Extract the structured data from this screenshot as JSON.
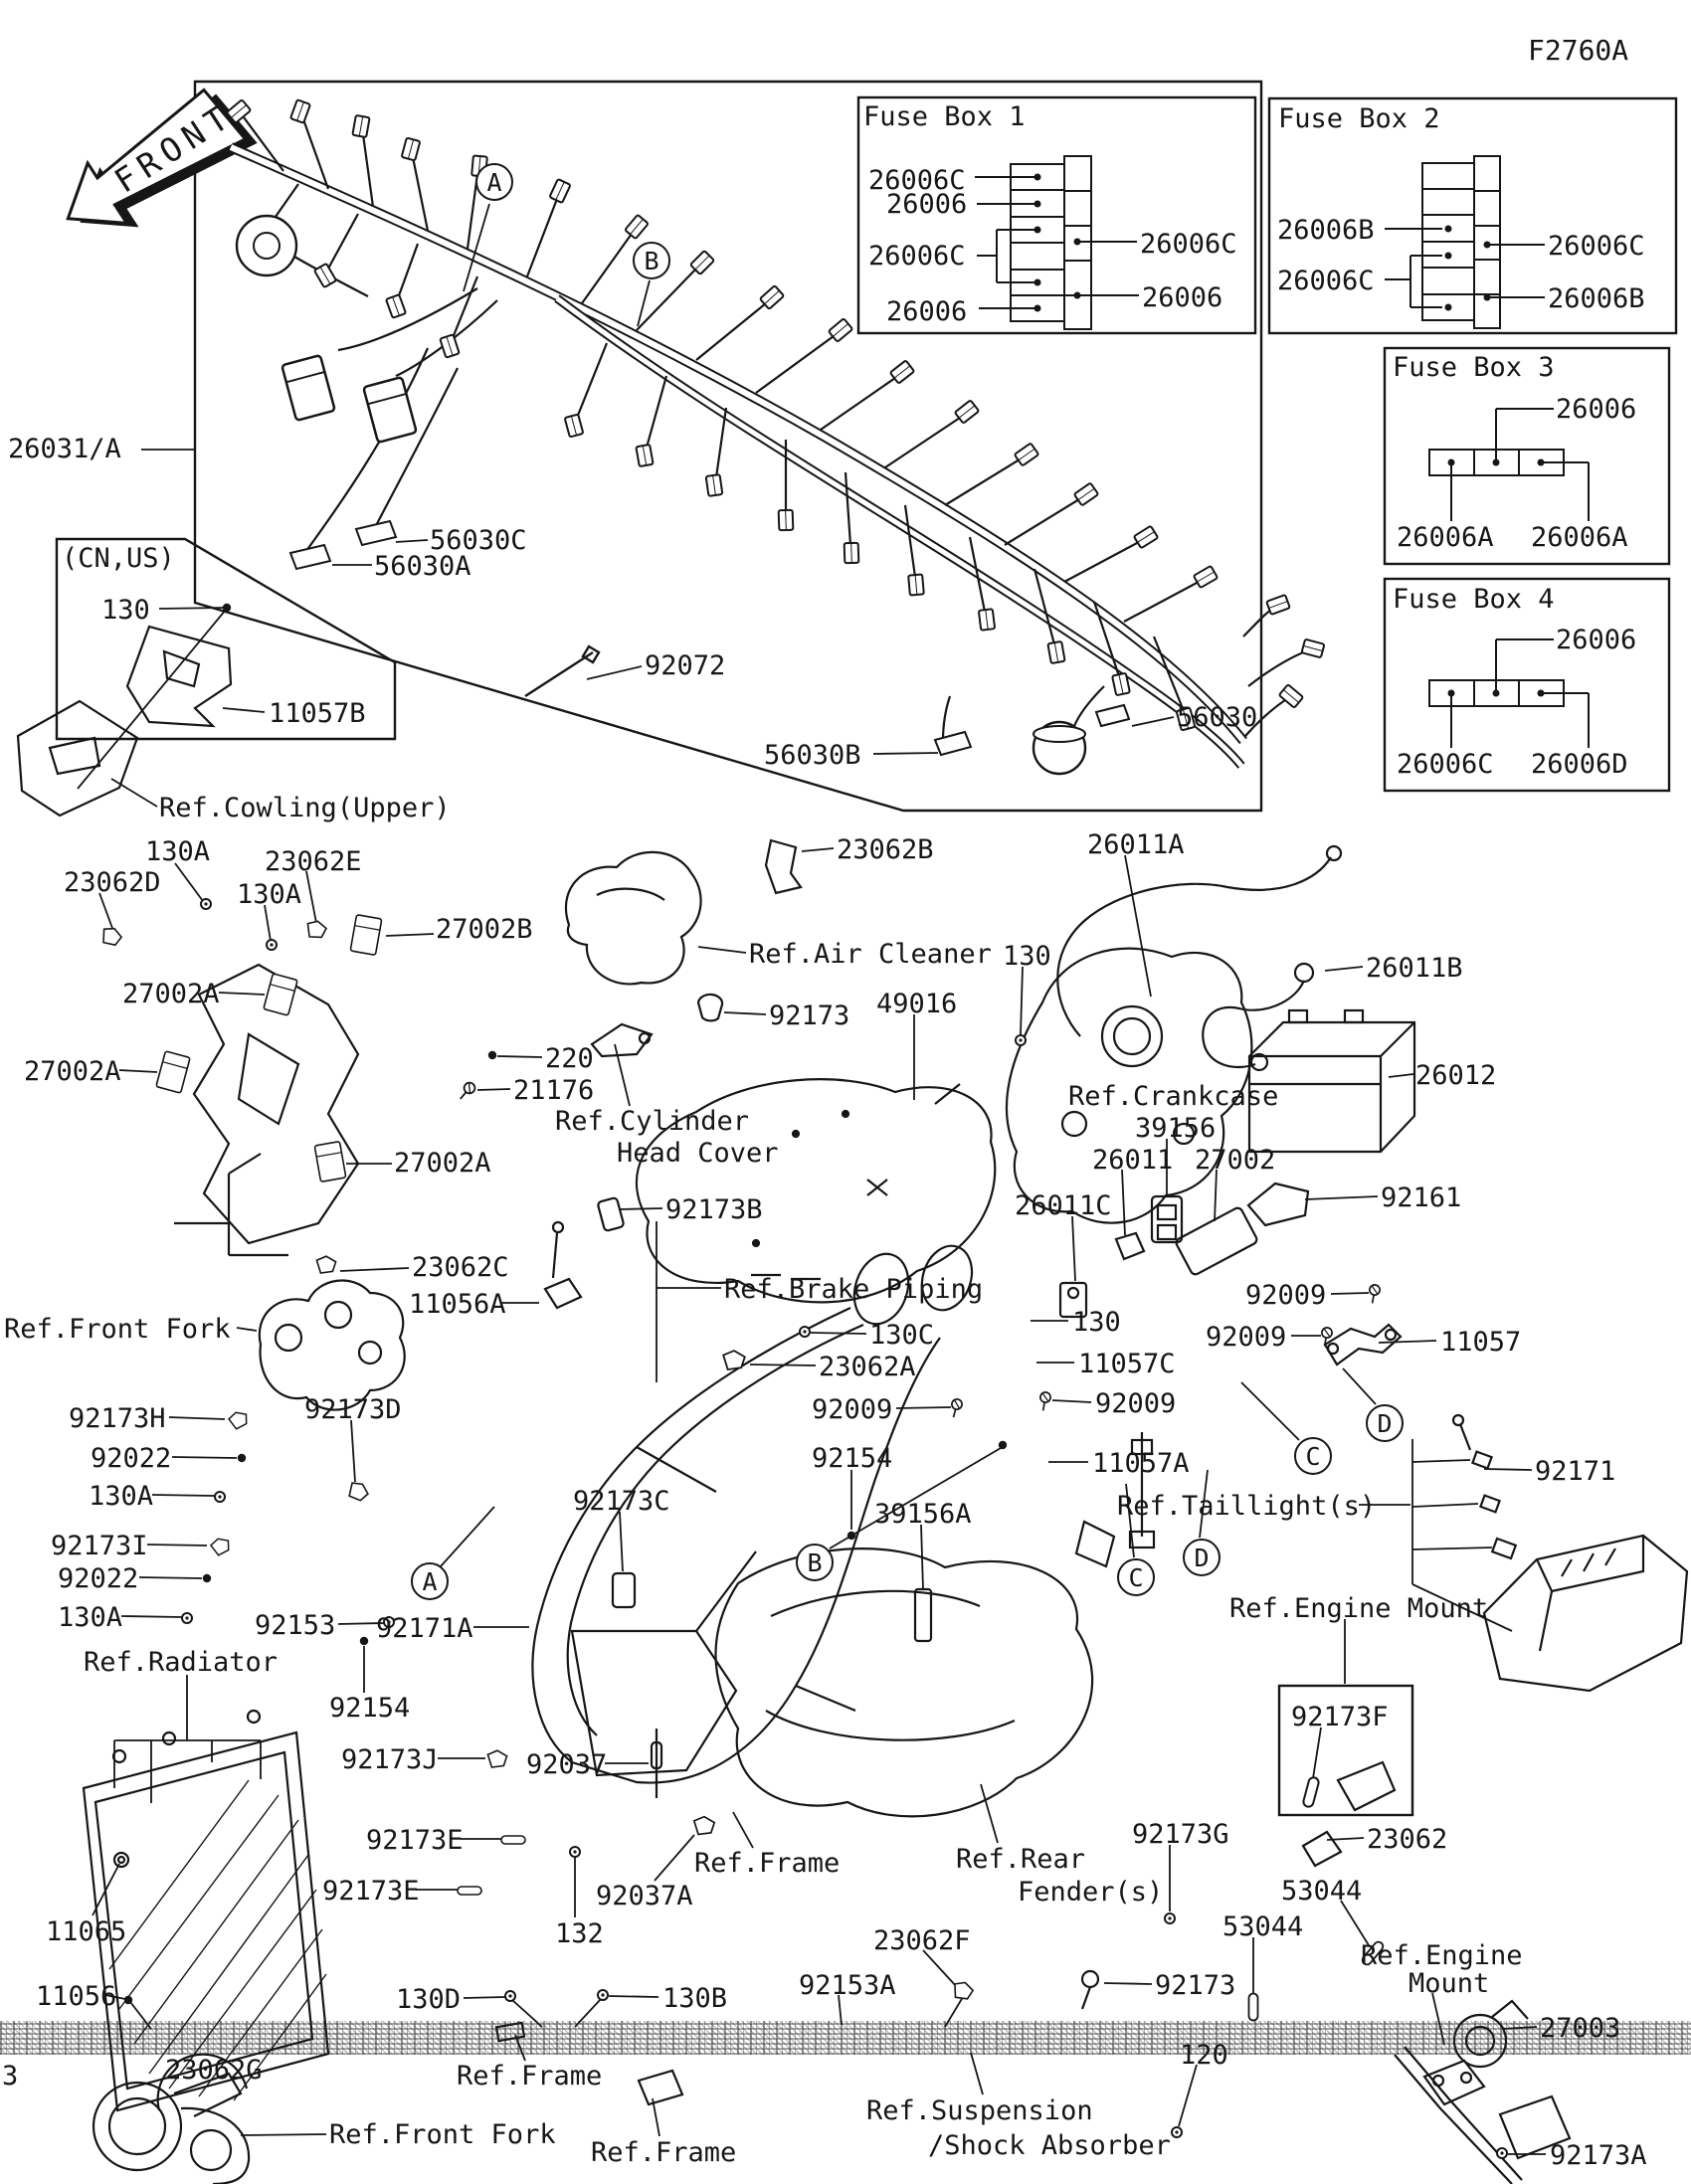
{
  "page": {
    "code": "F2760A",
    "front_arrow": "FRONT"
  },
  "fuse_boxes": [
    {
      "title": "Fuse Box 1",
      "left": [
        "26006C",
        "26006",
        "26006C",
        "26006"
      ],
      "right": [
        "26006C",
        "26006"
      ]
    },
    {
      "title": "Fuse Box 2",
      "left": [
        "26006B",
        "26006C"
      ],
      "right": [
        "26006C",
        "26006B"
      ]
    },
    {
      "title": "Fuse Box 3",
      "top": "26006",
      "bottom": [
        "26006A",
        "26006A"
      ]
    },
    {
      "title": "Fuse Box 4",
      "top": "26006",
      "bottom": [
        "26006C",
        "26006D"
      ]
    }
  ],
  "markers": [
    "A",
    "B",
    "A",
    "B",
    "C",
    "D",
    "C",
    "D"
  ],
  "labels": [
    {
      "text": "26031/A"
    },
    {
      "text": "56030C"
    },
    {
      "text": "56030A"
    },
    {
      "text": "92072"
    },
    {
      "text": "56030B"
    },
    {
      "text": "56030"
    },
    {
      "text": "(CN,US)"
    },
    {
      "text": "130"
    },
    {
      "text": "11057B"
    },
    {
      "text": "Ref.Cowling(Upper)"
    },
    {
      "text": "130A"
    },
    {
      "text": "23062D"
    },
    {
      "text": "23062E"
    },
    {
      "text": "130A"
    },
    {
      "text": "27002B"
    },
    {
      "text": "27002A"
    },
    {
      "text": "27002A"
    },
    {
      "text": "27002A"
    },
    {
      "text": "220"
    },
    {
      "text": "21176"
    },
    {
      "text": "Ref.Cylinder"
    },
    {
      "text": "Head Cover"
    },
    {
      "text": "92173"
    },
    {
      "text": "49016"
    },
    {
      "text": "Ref.Air Cleaner"
    },
    {
      "text": "130"
    },
    {
      "text": "23062B"
    },
    {
      "text": "26011A"
    },
    {
      "text": "26011B"
    },
    {
      "text": "26012"
    },
    {
      "text": "Ref.Crankcase"
    },
    {
      "text": "39156"
    },
    {
      "text": "26011"
    },
    {
      "text": "27002"
    },
    {
      "text": "26011C"
    },
    {
      "text": "92161"
    },
    {
      "text": "92009"
    },
    {
      "text": "92009"
    },
    {
      "text": "130"
    },
    {
      "text": "11057C"
    },
    {
      "text": "92009"
    },
    {
      "text": "11057"
    },
    {
      "text": "11057A"
    },
    {
      "text": "Ref.Taillight(s)"
    },
    {
      "text": "92171"
    },
    {
      "text": "Ref.Engine Mount"
    },
    {
      "text": "92173F"
    },
    {
      "text": "92173B"
    },
    {
      "text": "23062C"
    },
    {
      "text": "11056A"
    },
    {
      "text": "Ref.Front Fork"
    },
    {
      "text": "92173H"
    },
    {
      "text": "92022"
    },
    {
      "text": "130A"
    },
    {
      "text": "92173I"
    },
    {
      "text": "92022"
    },
    {
      "text": "130A"
    },
    {
      "text": "92173D"
    },
    {
      "text": "Ref.Brake Piping"
    },
    {
      "text": "130C"
    },
    {
      "text": "23062A"
    },
    {
      "text": "92009"
    },
    {
      "text": "92154"
    },
    {
      "text": "92173C"
    },
    {
      "text": "39156A"
    },
    {
      "text": "92153"
    },
    {
      "text": "92171A"
    },
    {
      "text": "Ref.Radiator"
    },
    {
      "text": "92154"
    },
    {
      "text": "92173J"
    },
    {
      "text": "92037"
    },
    {
      "text": "92173E"
    },
    {
      "text": "92173E"
    },
    {
      "text": "92037A"
    },
    {
      "text": "132"
    },
    {
      "text": "11065"
    },
    {
      "text": "130D"
    },
    {
      "text": "130B"
    },
    {
      "text": "Ref.Frame"
    },
    {
      "text": "Ref.Frame"
    },
    {
      "text": "Ref.Frame"
    },
    {
      "text": "Ref.Front Fork"
    },
    {
      "text": "11056"
    },
    {
      "text": "23062G"
    },
    {
      "text": "Ref.Rear"
    },
    {
      "text": "Fender(s)"
    },
    {
      "text": "92173G"
    },
    {
      "text": "23062F"
    },
    {
      "text": "92153A"
    },
    {
      "text": "92173"
    },
    {
      "text": "53044"
    },
    {
      "text": "53044"
    },
    {
      "text": "120"
    },
    {
      "text": "Ref.Suspension"
    },
    {
      "text": "/Shock Absorber"
    },
    {
      "text": "23062"
    },
    {
      "text": "Ref.Engine"
    },
    {
      "text": "Mount"
    },
    {
      "text": "27003"
    },
    {
      "text": "92173A"
    },
    {
      "text": "3"
    }
  ]
}
